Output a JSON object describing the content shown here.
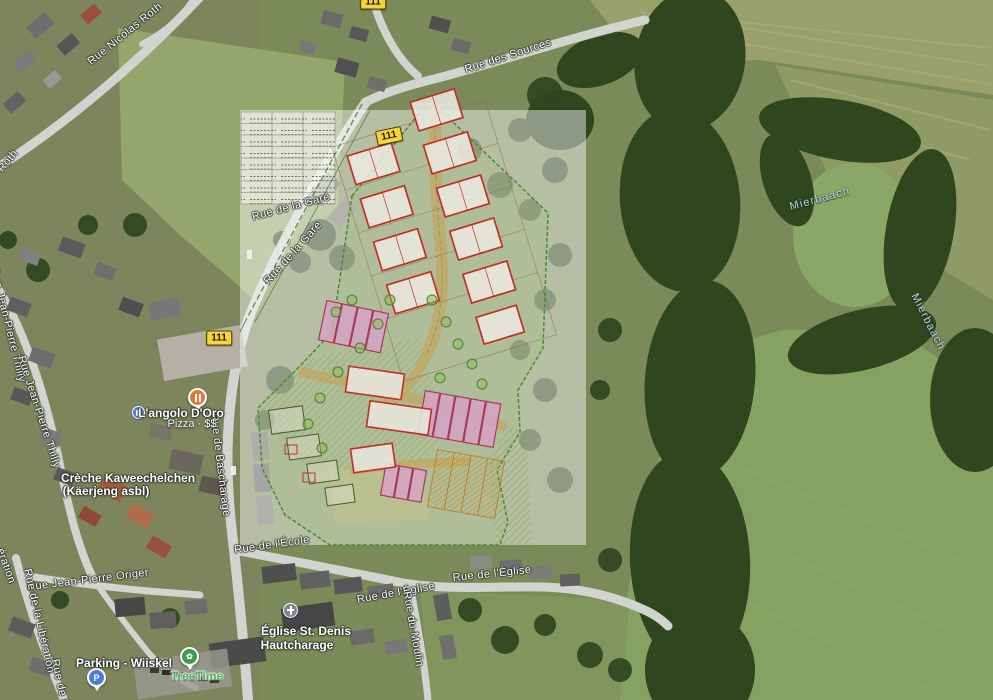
{
  "map": {
    "road_labels": [
      {
        "text": "Rue Nicolas Roth",
        "x": 125,
        "y": 34,
        "rot": -39
      },
      {
        "text": "Roth",
        "x": 8,
        "y": 161,
        "rot": -50
      },
      {
        "text": "Rue des Sources",
        "x": 508,
        "y": 56,
        "rot": -18
      },
      {
        "text": "Rue de la Gare",
        "x": 291,
        "y": 207,
        "rot": -15
      },
      {
        "text": "Rue de la Gare",
        "x": 293,
        "y": 253,
        "rot": -48
      },
      {
        "text": "Rue Jean-Pierre Thilly",
        "x": 8,
        "y": 325,
        "rot": 76
      },
      {
        "text": "Rue Jean-Pierre Thilly",
        "x": 39,
        "y": 412,
        "rot": 72
      },
      {
        "text": "Rue de Bascharage",
        "x": 220,
        "y": 465,
        "rot": 83
      },
      {
        "text": "Rue de l'École",
        "x": 272,
        "y": 545,
        "rot": -8
      },
      {
        "text": "Rue de l'Église",
        "x": 492,
        "y": 574,
        "rot": -6
      },
      {
        "text": "Rue de l'Église",
        "x": 396,
        "y": 593,
        "rot": -10
      },
      {
        "text": "Rue du Moulin",
        "x": 413,
        "y": 629,
        "rot": 80
      },
      {
        "text": "Rue Jean-Pierre Origer",
        "x": 88,
        "y": 580,
        "rot": -7
      },
      {
        "text": "Rue de la Libération",
        "x": 39,
        "y": 621,
        "rot": 77
      },
      {
        "text": "ération",
        "x": 6,
        "y": 566,
        "rot": 70
      },
      {
        "text": "Rue de la",
        "x": 60,
        "y": 684,
        "rot": 78
      }
    ],
    "water_labels": [
      {
        "text": "Mierbaach",
        "x": 820,
        "y": 199,
        "rot": -15
      },
      {
        "text": "Mierbaach",
        "x": 928,
        "y": 322,
        "rot": 63
      }
    ],
    "route_badges": [
      {
        "text": "111",
        "x": 219,
        "y": 338,
        "rot": 0
      },
      {
        "text": "111",
        "x": 389,
        "y": 136,
        "rot": -12
      },
      {
        "text": "111",
        "x": 373,
        "y": 2,
        "rot": 0
      }
    ],
    "pois": {
      "restaurant": {
        "name": "L'angolo D'Oro",
        "detail": "Pizza · $$"
      },
      "creche": {
        "line1": "Crèche Kaweechelchen",
        "line2": "(Käerjeng asbl)"
      },
      "church": {
        "line1": "Église St. Denis",
        "line2": "Hautcharage"
      },
      "parking": {
        "name": "Parking - Wiiskel"
      },
      "park": {
        "name": "TreeTime"
      }
    },
    "colors": {
      "route_badge": "#f7d43c",
      "water_label": "#b9d8ea",
      "park_label": "#4fb25c",
      "restaurant_pin": "#e07b36",
      "parking_pin": "#4a7fd4",
      "park_pin": "#3f9b4a",
      "church_icon": "#7a8591",
      "transit_icon": "#4a80d9",
      "plan_building_outline": "#c03028",
      "plan_rowhouse_fill": "#d7a2c5",
      "plan_orange": "#cf8c2e",
      "plan_green": "#6f9c3f"
    }
  }
}
